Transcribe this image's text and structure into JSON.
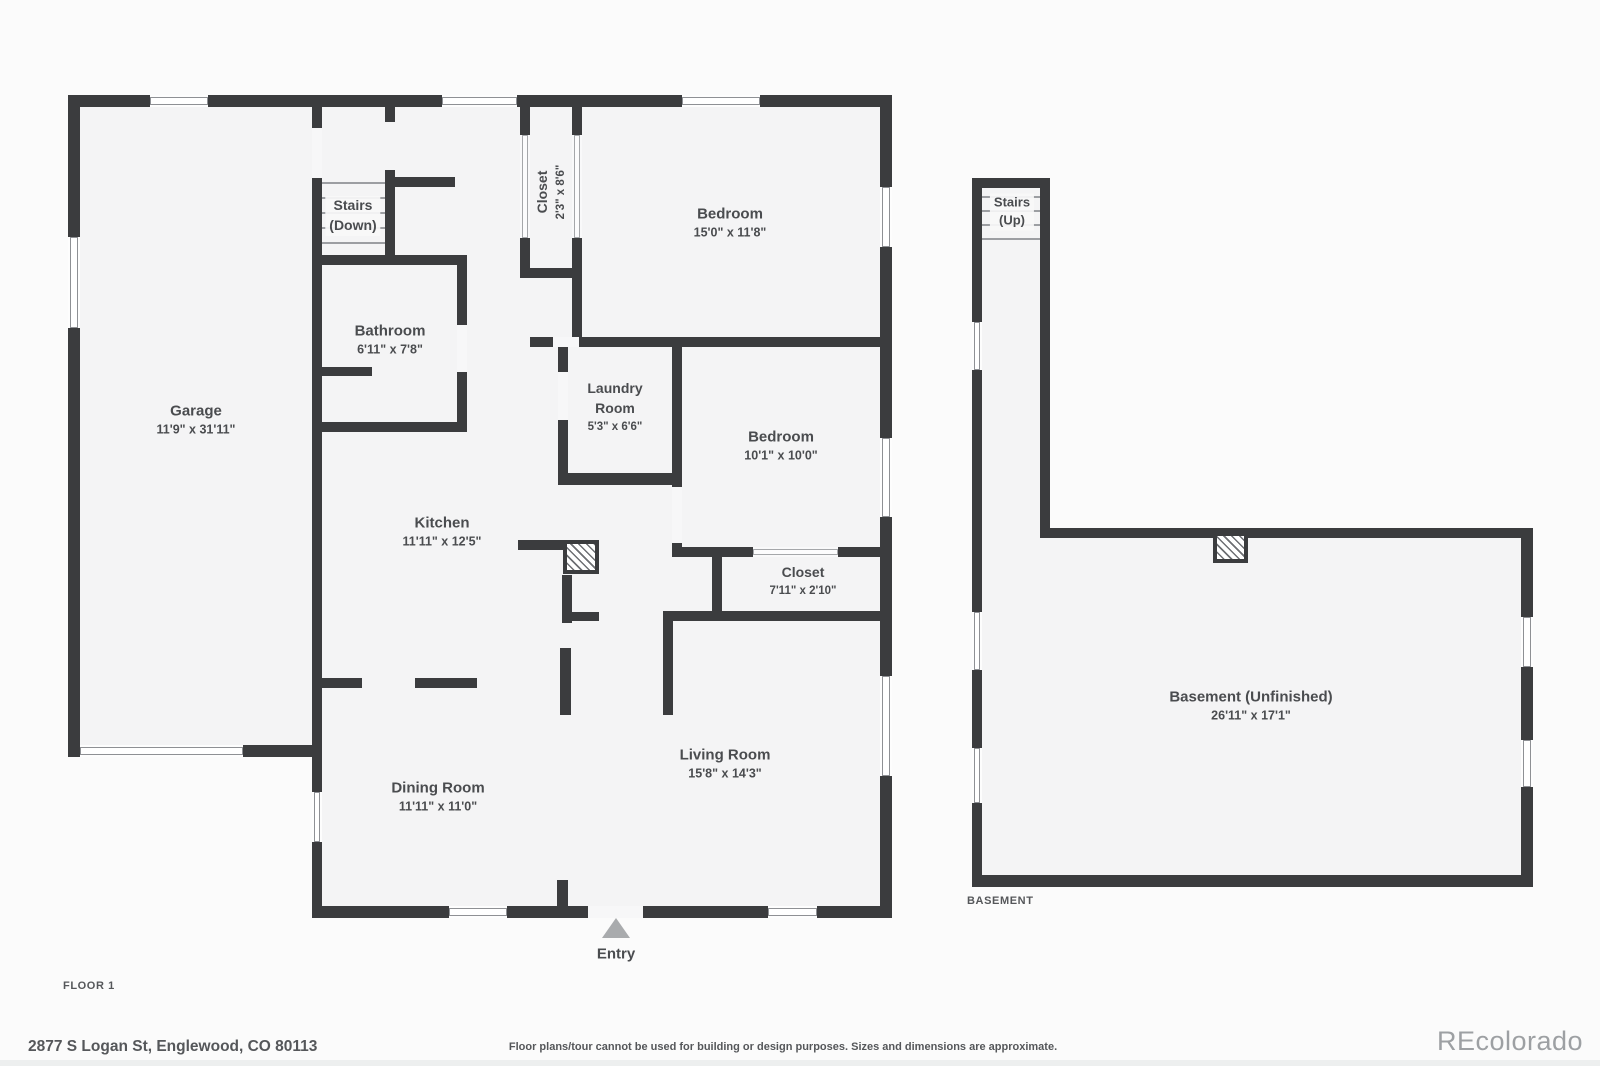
{
  "colors": {
    "wall": "#3b3c3e",
    "room_fill": "#f4f4f5",
    "page_bg": "#fbfbfb",
    "label": "#4a4c4f",
    "muted": "#55575a",
    "watermark": "#9da0a3",
    "entry_arrow": "#a9abad"
  },
  "footer": {
    "floor1_label": "FLOOR 1",
    "basement_label": "BASEMENT",
    "address": "2877 S Logan St, Englewood, CO 80113",
    "disclaimer": "Floor plans/tour cannot be used for building or design purposes. Sizes and dimensions are approximate.",
    "watermark": "REcolorado"
  },
  "plan": {
    "fills": [
      [
        80,
        107,
        232,
        638
      ],
      [
        322,
        107,
        558,
        799
      ],
      [
        982,
        188,
        58,
        350
      ],
      [
        982,
        538,
        539,
        337
      ]
    ],
    "walls": [
      [
        68,
        95,
        824,
        12
      ],
      [
        68,
        95,
        12,
        662
      ],
      [
        68,
        745,
        254,
        12
      ],
      [
        312,
        95,
        10,
        662
      ],
      [
        880,
        95,
        12,
        823
      ],
      [
        312,
        906,
        580,
        12
      ],
      [
        312,
        688,
        10,
        230
      ],
      [
        385,
        100,
        10,
        22
      ],
      [
        385,
        170,
        10,
        95
      ],
      [
        390,
        177,
        65,
        10
      ],
      [
        312,
        255,
        155,
        10
      ],
      [
        457,
        255,
        10,
        177
      ],
      [
        312,
        422,
        155,
        10
      ],
      [
        318,
        367,
        54,
        9
      ],
      [
        520,
        107,
        10,
        171
      ],
      [
        572,
        107,
        10,
        240
      ],
      [
        520,
        268,
        62,
        10
      ],
      [
        530,
        337,
        362,
        10
      ],
      [
        558,
        347,
        10,
        138
      ],
      [
        672,
        347,
        10,
        138
      ],
      [
        558,
        473,
        124,
        12
      ],
      [
        672,
        347,
        10,
        210
      ],
      [
        672,
        547,
        220,
        10
      ],
      [
        712,
        552,
        10,
        69
      ],
      [
        663,
        611,
        229,
        10
      ],
      [
        663,
        611,
        10,
        104
      ],
      [
        518,
        540,
        47,
        10
      ],
      [
        562,
        575,
        10,
        48
      ],
      [
        562,
        612,
        37,
        9
      ],
      [
        560,
        648,
        11,
        67
      ],
      [
        557,
        880,
        11,
        38
      ],
      [
        318,
        678,
        44,
        10
      ],
      [
        415,
        678,
        62,
        10
      ],
      [
        972,
        178,
        78,
        10
      ],
      [
        972,
        178,
        10,
        709
      ],
      [
        1040,
        178,
        10,
        360
      ],
      [
        1040,
        528,
        493,
        10
      ],
      [
        1521,
        528,
        12,
        359
      ],
      [
        972,
        875,
        561,
        12
      ]
    ],
    "openings": [
      [
        312,
        128,
        10,
        50
      ],
      [
        457,
        325,
        10,
        47
      ],
      [
        558,
        372,
        10,
        48
      ],
      [
        553,
        337,
        26,
        10
      ],
      [
        672,
        487,
        10,
        56
      ],
      [
        588,
        906,
        55,
        12
      ]
    ],
    "windows": [
      [
        150,
        95,
        58,
        12
      ],
      [
        442,
        95,
        75,
        12
      ],
      [
        682,
        95,
        78,
        12
      ],
      [
        68,
        237,
        12,
        91
      ],
      [
        880,
        187,
        12,
        60
      ],
      [
        880,
        438,
        12,
        79
      ],
      [
        880,
        676,
        12,
        100
      ],
      [
        312,
        792,
        10,
        50
      ],
      [
        449,
        906,
        58,
        12
      ],
      [
        768,
        906,
        49,
        12
      ],
      [
        80,
        745,
        163,
        12
      ],
      [
        972,
        322,
        10,
        48
      ],
      [
        972,
        612,
        10,
        58
      ],
      [
        972,
        748,
        10,
        55
      ],
      [
        1521,
        617,
        12,
        50
      ],
      [
        1521,
        740,
        12,
        47
      ]
    ],
    "door_symbols": [
      [
        520,
        135,
        10,
        103
      ],
      [
        572,
        135,
        10,
        103
      ],
      [
        753,
        547,
        85,
        10
      ]
    ],
    "treads": [
      [
        322,
        182,
        63,
        2
      ],
      [
        322,
        197,
        63,
        2
      ],
      [
        322,
        212,
        63,
        2
      ],
      [
        322,
        227,
        63,
        2
      ],
      [
        322,
        242,
        63,
        2
      ],
      [
        982,
        196,
        58,
        2
      ],
      [
        982,
        210,
        58,
        2
      ],
      [
        982,
        224,
        58,
        2
      ],
      [
        982,
        238,
        58,
        2
      ]
    ],
    "chimneys": [
      [
        563,
        540,
        36,
        34
      ],
      [
        1213,
        532,
        35,
        31
      ]
    ],
    "entry_marker": {
      "x": 602,
      "y": 918
    },
    "labels": [
      {
        "id": "garage",
        "x": 196,
        "y": 420,
        "lines": [
          {
            "t": "Garage",
            "fs": 15
          },
          {
            "t": "11'9\" x 31'11\"",
            "fs": 12.5
          }
        ]
      },
      {
        "id": "stairs-down",
        "x": 353,
        "y": 216,
        "halo": true,
        "lines": [
          {
            "t": "Stairs",
            "fs": 14
          },
          {
            "t": "(Down)",
            "fs": 14
          }
        ]
      },
      {
        "id": "bathroom",
        "x": 390,
        "y": 340,
        "lines": [
          {
            "t": "Bathroom",
            "fs": 15
          },
          {
            "t": "6'11\" x 7'8\"",
            "fs": 12.5
          }
        ]
      },
      {
        "id": "closet-hall",
        "x": 551,
        "y": 192,
        "rot": true,
        "lines": [
          {
            "t": "Closet",
            "fs": 14
          },
          {
            "t": "2'3\" x 8'6\"",
            "fs": 11.5
          }
        ]
      },
      {
        "id": "bedroom-1",
        "x": 730,
        "y": 223,
        "lines": [
          {
            "t": "Bedroom",
            "fs": 15
          },
          {
            "t": "15'0\" x 11'8\"",
            "fs": 12.5
          }
        ]
      },
      {
        "id": "laundry-room",
        "x": 615,
        "y": 407,
        "lines": [
          {
            "t": "Laundry",
            "fs": 14
          },
          {
            "t": "Room",
            "fs": 14
          },
          {
            "t": "5'3\" x 6'6\"",
            "fs": 11.5
          }
        ]
      },
      {
        "id": "bedroom-2",
        "x": 781,
        "y": 446,
        "lines": [
          {
            "t": "Bedroom",
            "fs": 15
          },
          {
            "t": "10'1\" x 10'0\"",
            "fs": 12.5
          }
        ]
      },
      {
        "id": "closet-bedroom",
        "x": 803,
        "y": 581,
        "lines": [
          {
            "t": "Closet",
            "fs": 14
          },
          {
            "t": "7'11\" x 2'10\"",
            "fs": 11.5
          }
        ]
      },
      {
        "id": "kitchen",
        "x": 442,
        "y": 532,
        "lines": [
          {
            "t": "Kitchen",
            "fs": 15
          },
          {
            "t": "11'11\" x 12'5\"",
            "fs": 12.5
          }
        ]
      },
      {
        "id": "dining-room",
        "x": 438,
        "y": 797,
        "lines": [
          {
            "t": "Dining Room",
            "fs": 15
          },
          {
            "t": "11'11\" x 11'0\"",
            "fs": 12.5
          }
        ]
      },
      {
        "id": "living-room",
        "x": 725,
        "y": 764,
        "lines": [
          {
            "t": "Living Room",
            "fs": 15
          },
          {
            "t": "15'8\" x 14'3\"",
            "fs": 12.5
          }
        ]
      },
      {
        "id": "entry",
        "x": 616,
        "y": 954,
        "lines": [
          {
            "t": "Entry",
            "fs": 15
          }
        ]
      },
      {
        "id": "stairs-up",
        "x": 1012,
        "y": 212,
        "halo": true,
        "lines": [
          {
            "t": "Stairs",
            "fs": 13
          },
          {
            "t": "(Up)",
            "fs": 13
          }
        ]
      },
      {
        "id": "basement",
        "x": 1251,
        "y": 706,
        "lines": [
          {
            "t": "Basement (Unfinished)",
            "fs": 15
          },
          {
            "t": "26'11\" x 17'1\"",
            "fs": 12.5
          }
        ]
      }
    ]
  }
}
